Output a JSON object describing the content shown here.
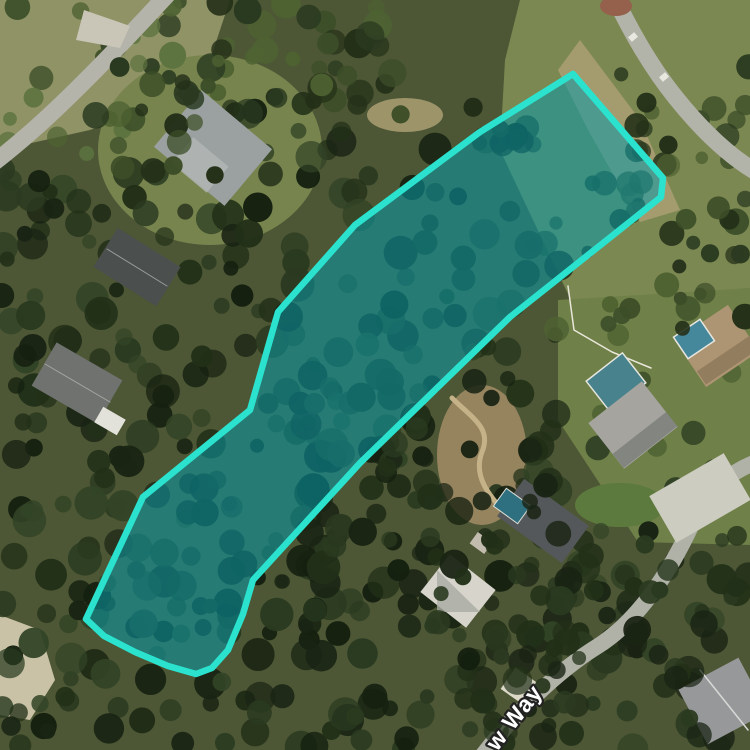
{
  "map": {
    "street_label": {
      "text": "w Way",
      "x": 497,
      "y": 752,
      "rotation": -52,
      "font_size": 23,
      "fill": "#ffffff",
      "halo": "#222222",
      "halo_width": 4.5
    },
    "parcel": {
      "points": [
        [
          573,
          74
        ],
        [
          663,
          178
        ],
        [
          661,
          197
        ],
        [
          510,
          317
        ],
        [
          360,
          463
        ],
        [
          253,
          580
        ],
        [
          243,
          614
        ],
        [
          228,
          650
        ],
        [
          212,
          668
        ],
        [
          196,
          674
        ],
        [
          168,
          666
        ],
        [
          135,
          652
        ],
        [
          104,
          636
        ],
        [
          86,
          619
        ],
        [
          143,
          497
        ],
        [
          250,
          410
        ],
        [
          278,
          312
        ],
        [
          355,
          225
        ],
        [
          480,
          132
        ]
      ],
      "stroke": "#2be2ce",
      "stroke_width": 6.5,
      "fill": "#0899a8",
      "fill_opacity": 0.55
    }
  },
  "scene": {
    "base_color": "#4d5735",
    "ground": [
      {
        "type": "polygon",
        "points": [
          [
            520,
            0
          ],
          [
            750,
            0
          ],
          [
            750,
            345
          ],
          [
            585,
            330
          ],
          [
            500,
            150
          ],
          [
            505,
            60
          ]
        ],
        "fill": "#7c8852"
      },
      {
        "type": "polygon",
        "points": [
          [
            580,
            40
          ],
          [
            640,
            120
          ],
          [
            680,
            210
          ],
          [
            640,
            222
          ],
          [
            588,
            130
          ],
          [
            558,
            70
          ]
        ],
        "fill": "#a89e72",
        "opacity": 0.9
      },
      {
        "type": "polygon",
        "points": [
          [
            0,
            0
          ],
          [
            230,
            0
          ],
          [
            200,
            90
          ],
          [
            90,
            130
          ],
          [
            0,
            150
          ]
        ],
        "fill": "#8f9365"
      },
      {
        "type": "ellipse",
        "cx": 210,
        "cy": 150,
        "rx": 112,
        "ry": 95,
        "fill": "#77844e"
      },
      {
        "type": "polygon",
        "points": [
          [
            558,
            300
          ],
          [
            750,
            288
          ],
          [
            750,
            545
          ],
          [
            638,
            542
          ],
          [
            558,
            420
          ]
        ],
        "fill": "#6f8049"
      },
      {
        "type": "ellipse",
        "cx": 482,
        "cy": 455,
        "rx": 45,
        "ry": 70,
        "fill": "#9f8a64",
        "opacity": 0.9
      },
      {
        "type": "polygon",
        "points": [
          [
            0,
            615
          ],
          [
            40,
            630
          ],
          [
            55,
            680
          ],
          [
            30,
            720
          ],
          [
            0,
            715
          ]
        ],
        "fill": "#c9c2a6"
      },
      {
        "type": "ellipse",
        "cx": 405,
        "cy": 115,
        "rx": 38,
        "ry": 17,
        "fill": "#b1a478",
        "opacity": 0.8
      },
      {
        "type": "ellipse",
        "cx": 620,
        "cy": 505,
        "rx": 45,
        "ry": 22,
        "fill": "#5d7a3e"
      }
    ],
    "forest": [
      {
        "x": 0,
        "y": 170,
        "w": 250,
        "h": 340,
        "count": 90,
        "rmin": 7,
        "rmax": 17,
        "seed": 11,
        "palette": [
          "#1a2414",
          "#223018",
          "#2a3a20",
          "#152010",
          "#324426"
        ]
      },
      {
        "x": 230,
        "y": 100,
        "w": 330,
        "h": 390,
        "count": 110,
        "rmin": 7,
        "rmax": 17,
        "seed": 22,
        "palette": [
          "#1a2414",
          "#223018",
          "#2a3a20",
          "#152010",
          "#324426"
        ]
      },
      {
        "x": 210,
        "y": 0,
        "w": 200,
        "h": 120,
        "count": 40,
        "rmin": 7,
        "rmax": 15,
        "seed": 33,
        "palette": [
          "#2a3a20",
          "#3c4e28",
          "#4e6232",
          "#243018"
        ]
      },
      {
        "x": 0,
        "y": 500,
        "w": 330,
        "h": 250,
        "count": 95,
        "rmin": 7,
        "rmax": 17,
        "seed": 44,
        "palette": [
          "#1a2414",
          "#223018",
          "#2a3a20",
          "#152010",
          "#324426"
        ]
      },
      {
        "x": 300,
        "y": 470,
        "w": 270,
        "h": 280,
        "count": 85,
        "rmin": 7,
        "rmax": 17,
        "seed": 55,
        "palette": [
          "#1a2414",
          "#223018",
          "#2a3a20",
          "#152010"
        ]
      },
      {
        "x": 545,
        "y": 530,
        "w": 205,
        "h": 220,
        "count": 55,
        "rmin": 7,
        "rmax": 16,
        "seed": 66,
        "palette": [
          "#1a2414",
          "#223018",
          "#2a3a20",
          "#324426"
        ]
      },
      {
        "x": 545,
        "y": 180,
        "w": 205,
        "h": 330,
        "count": 30,
        "rmin": 6,
        "rmax": 14,
        "seed": 77,
        "palette": [
          "#2a3a20",
          "#3c4e28",
          "#4e6232",
          "#243018"
        ]
      },
      {
        "x": 620,
        "y": 30,
        "w": 130,
        "h": 190,
        "count": 22,
        "rmin": 6,
        "rmax": 13,
        "seed": 88,
        "palette": [
          "#2a3a20",
          "#3c4e28",
          "#4e6232",
          "#243018"
        ]
      },
      {
        "x": 0,
        "y": 0,
        "w": 220,
        "h": 170,
        "count": 30,
        "rmin": 6,
        "rmax": 14,
        "seed": 99,
        "palette": [
          "#2a3a20",
          "#3c4e28",
          "#4e6232",
          "#5d7340"
        ]
      }
    ],
    "roads": [
      {
        "d": "M 168,-6 C 120,46 64,104 24,138 C 10,150 0,158 -8,164",
        "width": 17,
        "color": "#b4b4aa"
      },
      {
        "d": "M 612,-8 C 628,26 650,66 676,98 C 700,128 726,154 756,172",
        "width": 17,
        "color": "#b2b3a9"
      },
      {
        "d": "M 482,756 C 516,712 556,672 598,646 C 636,622 668,576 692,524 C 700,504 716,478 756,462",
        "width": 16,
        "color": "#b0b1a7"
      }
    ],
    "buildings": [
      {
        "type": "polygon",
        "points": [
          [
            84,
            10
          ],
          [
            130,
            26
          ],
          [
            120,
            48
          ],
          [
            76,
            40
          ]
        ],
        "fill": "#c9c5b7"
      },
      {
        "type": "ellipse",
        "cx": 616,
        "cy": 6,
        "rx": 16,
        "ry": 10,
        "fill": "#95604c"
      },
      {
        "type": "rect",
        "cx": 700,
        "cy": 498,
        "w": 86,
        "h": 54,
        "rot": -30,
        "fill": "#ccccc0"
      },
      {
        "type": "rect",
        "cx": 522,
        "cy": 688,
        "w": 34,
        "h": 26,
        "rot": 35,
        "fill": "#dcd9c9"
      },
      {
        "type": "rect",
        "cx": 664,
        "cy": 77,
        "w": 8,
        "h": 6,
        "rot": -40,
        "fill": "#e8e8e0"
      },
      {
        "type": "rect",
        "cx": 633,
        "cy": 37,
        "w": 8,
        "h": 6,
        "rot": -40,
        "fill": "#e8e8e0"
      },
      {
        "type": "rect",
        "cx": 218,
        "cy": 118,
        "w": 95,
        "h": 18,
        "rot": 40,
        "fill": "#2f3538",
        "opacity": 0.85
      },
      {
        "type": "rect",
        "cx": 213,
        "cy": 148,
        "w": 92,
        "h": 74,
        "rot": 40,
        "fill": "#9ba1a0"
      },
      {
        "type": "rect",
        "cx": 200,
        "cy": 165,
        "w": 46,
        "h": 34,
        "rot": 40,
        "fill": "#b3b8b6",
        "opacity": 0.8
      },
      {
        "type": "rect",
        "cx": 137,
        "cy": 267,
        "w": 74,
        "h": 46,
        "rot": 32,
        "fill": "#4b4f4d"
      },
      {
        "type": "line",
        "x1": 107,
        "y1": 249,
        "x2": 167,
        "y2": 286,
        "stroke": "#9b9e9c",
        "sw": 1
      },
      {
        "type": "rect",
        "cx": 77,
        "cy": 383,
        "w": 76,
        "h": 50,
        "rot": 30,
        "fill": "#6f726e"
      },
      {
        "type": "line",
        "x1": 45,
        "y1": 364,
        "x2": 110,
        "y2": 402,
        "stroke": "#a3a5a1",
        "sw": 1
      },
      {
        "type": "rect",
        "cx": 110,
        "cy": 421,
        "w": 26,
        "h": 18,
        "rot": 30,
        "fill": "#e3e2da"
      },
      {
        "type": "path",
        "d": "M 452,398 C 472,418 492,428 482,452 C 472,478 492,498 506,514",
        "stroke": "#c6b288",
        "sw": 5
      },
      {
        "type": "rect",
        "cx": 481,
        "cy": 543,
        "w": 18,
        "h": 14,
        "rot": 36,
        "fill": "#c2bcae"
      },
      {
        "type": "rect",
        "cx": 543,
        "cy": 521,
        "w": 80,
        "h": 46,
        "rot": 36,
        "fill": "#54585a"
      },
      {
        "type": "rect",
        "cx": 512,
        "cy": 506,
        "w": 30,
        "h": 22,
        "rot": 36,
        "fill": "#2e7080",
        "stroke": "#dfe0d8",
        "sw": 1
      },
      {
        "type": "path",
        "d": "M 568,286 L 574,330 L 612,352 L 651,368",
        "stroke": "#e9e7d9",
        "sw": 1.5
      },
      {
        "type": "rect",
        "cx": 616,
        "cy": 382,
        "w": 46,
        "h": 38,
        "rot": -38,
        "fill": "#48828c",
        "stroke": "#e6e6de",
        "sw": 1.5
      },
      {
        "type": "rect",
        "cx": 633,
        "cy": 425,
        "w": 68,
        "h": 58,
        "rot": -38,
        "fill": "#a5a49f"
      },
      {
        "type": "rect",
        "cx": 645,
        "cy": 440,
        "w": 68,
        "h": 18,
        "rot": -38,
        "fill": "#7b7d79",
        "opacity": 0.8
      },
      {
        "type": "rect",
        "cx": 717,
        "cy": 346,
        "w": 64,
        "h": 56,
        "rot": -34,
        "fill": "#ad9573"
      },
      {
        "type": "rect",
        "cx": 728,
        "cy": 360,
        "w": 64,
        "h": 16,
        "rot": -34,
        "fill": "#8f7a5c",
        "opacity": 0.9
      },
      {
        "type": "rect",
        "cx": 694,
        "cy": 339,
        "w": 32,
        "h": 26,
        "rot": -34,
        "fill": "#45889c",
        "stroke": "#e6e6de",
        "sw": 1.5
      },
      {
        "type": "rect",
        "cx": 458,
        "cy": 591,
        "w": 58,
        "h": 48,
        "rot": 38,
        "fill": "#d6d4cb"
      },
      {
        "type": "polygon",
        "points": [
          [
            437,
            570
          ],
          [
            480,
            612
          ],
          [
            437,
            612
          ]
        ],
        "fill": "#a9aaa3",
        "opacity": 0.8
      },
      {
        "type": "rect",
        "cx": 723,
        "cy": 701,
        "w": 68,
        "h": 62,
        "rot": -28,
        "fill": "#96989a"
      },
      {
        "type": "line",
        "x1": 700,
        "y1": 670,
        "x2": 748,
        "y2": 730,
        "stroke": "#d8d9d6",
        "sw": 1.5
      }
    ],
    "canopy": [
      {
        "x": 550,
        "y": 560,
        "w": 200,
        "h": 190,
        "count": 26,
        "rmin": 7,
        "rmax": 16,
        "seed": 101,
        "palette": [
          "#1a2414",
          "#223018",
          "#2a3a20"
        ]
      },
      {
        "x": 80,
        "y": 60,
        "w": 140,
        "h": 120,
        "count": 14,
        "rmin": 6,
        "rmax": 14,
        "seed": 102,
        "palette": [
          "#2a3a20",
          "#3c4e28",
          "#243018"
        ]
      },
      {
        "x": 430,
        "y": 540,
        "w": 140,
        "h": 200,
        "count": 30,
        "rmin": 7,
        "rmax": 15,
        "seed": 103,
        "palette": [
          "#1a2414",
          "#223018",
          "#2a3a20"
        ]
      },
      {
        "x": 300,
        "y": 380,
        "w": 260,
        "h": 160,
        "count": 35,
        "rmin": 7,
        "rmax": 15,
        "seed": 104,
        "palette": [
          "#1a2414",
          "#223018",
          "#2a3a20"
        ]
      },
      {
        "x": 660,
        "y": 190,
        "w": 90,
        "h": 140,
        "count": 12,
        "rmin": 6,
        "rmax": 13,
        "seed": 105,
        "palette": [
          "#2a3a20",
          "#3c4e28",
          "#243018"
        ]
      }
    ]
  }
}
